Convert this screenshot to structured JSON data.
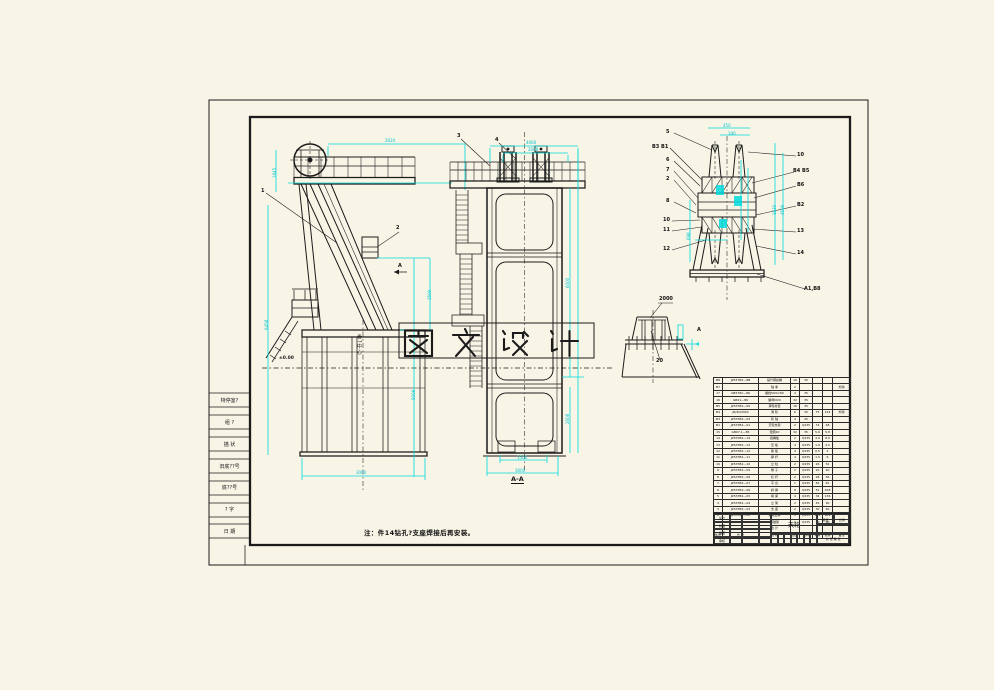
{
  "meta": {
    "background": "#f8f4e6",
    "ink": "#1b1b1b",
    "dim_color": "#00dcdc",
    "watermark_bg": "#ffffff"
  },
  "watermark": {
    "text": "图 文 设 计"
  },
  "note": {
    "text": "注：件14钻孔?支座焊接后再安装。"
  },
  "labels": {
    "ground": "±0.00",
    "hoist_center": "卷?中心",
    "section": "A-A"
  },
  "revision_strip": {
    "rows": [
      "特停室?",
      "组 ?",
      "描 状",
      "旧底??号",
      "底??号",
      "? 字",
      "日 期"
    ]
  },
  "annotations": {
    "callouts": [
      {
        "t": "1",
        "x": 261,
        "y": 189
      },
      {
        "t": "2",
        "x": 396,
        "y": 226
      },
      {
        "t": "A",
        "x": 398,
        "y": 264
      },
      {
        "t": "3",
        "x": 457,
        "y": 134
      },
      {
        "t": "4",
        "x": 495,
        "y": 138
      },
      {
        "t": "5",
        "x": 666,
        "y": 130
      },
      {
        "t": "B3 B1",
        "x": 652,
        "y": 145
      },
      {
        "t": "6",
        "x": 666,
        "y": 158
      },
      {
        "t": "7",
        "x": 666,
        "y": 168
      },
      {
        "t": "2",
        "x": 666,
        "y": 177
      },
      {
        "t": "8",
        "x": 666,
        "y": 199
      },
      {
        "t": "10",
        "x": 663,
        "y": 218
      },
      {
        "t": "11",
        "x": 663,
        "y": 228
      },
      {
        "t": "12",
        "x": 663,
        "y": 247
      },
      {
        "t": "10",
        "x": 797,
        "y": 153
      },
      {
        "t": "B4 B5",
        "x": 793,
        "y": 169
      },
      {
        "t": "B6",
        "x": 797,
        "y": 183
      },
      {
        "t": "B2",
        "x": 797,
        "y": 203
      },
      {
        "t": "13",
        "x": 797,
        "y": 229
      },
      {
        "t": "14",
        "x": 797,
        "y": 251
      },
      {
        "t": "A1,B8",
        "x": 804,
        "y": 287
      },
      {
        "t": "2000",
        "x": 659,
        "y": 297
      },
      {
        "t": "20",
        "x": 656,
        "y": 359
      },
      {
        "t": "A",
        "x": 697,
        "y": 328
      }
    ],
    "dims": [
      {
        "t": "2024",
        "x": 385,
        "y": 139
      },
      {
        "t": "1845",
        "x": 273,
        "y": 178,
        "r": 1
      },
      {
        "t": "6458",
        "x": 265,
        "y": 330,
        "r": 1
      },
      {
        "t": "1500",
        "x": 428,
        "y": 300,
        "r": 1
      },
      {
        "t": "5008",
        "x": 412,
        "y": 400,
        "r": 1
      },
      {
        "t": "3000",
        "x": 356,
        "y": 471
      },
      {
        "t": "4060",
        "x": 526,
        "y": 141
      },
      {
        "t": "2008",
        "x": 528,
        "y": 148
      },
      {
        "t": "6000",
        "x": 566,
        "y": 288,
        "r": 1
      },
      {
        "t": "2608",
        "x": 566,
        "y": 424,
        "r": 1
      },
      {
        "t": "1500",
        "x": 517,
        "y": 456
      },
      {
        "t": "3000",
        "x": 515,
        "y": 469
      },
      {
        "t": "450",
        "x": 723,
        "y": 124
      },
      {
        "t": "340",
        "x": 728,
        "y": 132
      },
      {
        "t": "1630",
        "x": 773,
        "y": 215,
        "r": 1
      },
      {
        "t": "4500",
        "x": 781,
        "y": 215,
        "r": 1
      },
      {
        "t": "698",
        "x": 687,
        "y": 240,
        "r": 1
      }
    ]
  },
  "bom": {
    "rows": [
      [
        "B8",
        "JZ537B2—8B",
        "提升钢丝绳",
        "16",
        "35",
        "",
        "",
        ""
      ],
      [
        "B7",
        "",
        "轴  承",
        "2",
        "",
        "",
        "",
        "外购"
      ],
      [
        "17",
        "GB5782—86",
        "螺栓M20×80",
        "4",
        "35",
        "",
        "",
        ""
      ],
      [
        "16",
        "GB41—86",
        "螺母M20",
        "32",
        "35",
        "",
        "",
        ""
      ],
      [
        "B5",
        "JZ537B2—05",
        "滑轮衬垫",
        "16",
        "35",
        "",
        "",
        ""
      ],
      [
        "B4",
        "JB/ZQ4390",
        "滑  轮",
        "6",
        "35",
        "75",
        "144",
        "外购"
      ],
      [
        "B3",
        "JZ537B2—03",
        "轮  轴",
        "4",
        "45",
        "",
        "",
        ""
      ],
      [
        "B1",
        "JZ537B2—01",
        "天轮支架",
        "2",
        "Q235",
        "74",
        "48",
        ""
      ],
      [
        "15",
        "GB97.1—85",
        "垫圈20",
        "32",
        "35",
        "5.9",
        "5.8",
        ""
      ],
      [
        "14",
        "JZ537B2—14",
        "挡绳板",
        "2",
        "Q235",
        "4.0",
        "8.0",
        ""
      ],
      [
        "13",
        "JZ537B2—13",
        "压  板",
        "4",
        "Q235",
        "1.0",
        "4.0",
        ""
      ],
      [
        "12",
        "JZ537B2—12",
        "筋  板",
        "4",
        "Q235",
        "0.5",
        "2",
        ""
      ],
      [
        "11",
        "JZ537B2—11",
        "撑  杆",
        "4",
        "Q235",
        "1.5",
        "6",
        ""
      ],
      [
        "10",
        "JZ537B2—10",
        "立  柱",
        "2",
        "Q235",
        "26",
        "52",
        ""
      ],
      [
        "9",
        "JZ537B2—09",
        "梯  子",
        "2",
        "Q235",
        "20",
        "40",
        ""
      ],
      [
        "8",
        "JZ537B2—08",
        "栏  杆",
        "2",
        "Q235",
        "28",
        "56",
        ""
      ],
      [
        "7",
        "JZ537B2—07",
        "平  台",
        "1",
        "Q235",
        "81",
        "81",
        ""
      ],
      [
        "6",
        "JZ537B2—06",
        "斜  撑",
        "8",
        "Q235",
        "51",
        "408",
        ""
      ],
      [
        "5",
        "JZ537B2—05",
        "横  梁",
        "4",
        "Q235",
        "34",
        "136",
        ""
      ],
      [
        "4",
        "JZ537B2—04",
        "立  架",
        "2",
        "Q235",
        "45",
        "90",
        ""
      ],
      [
        "3",
        "JZ537B2—03",
        "支  座",
        "2",
        "Q235",
        "30",
        "60",
        ""
      ],
      [
        "2",
        "JZ537B2—02",
        "井架主体",
        "1",
        "Q235",
        "981",
        "981",
        ""
      ],
      [
        "1",
        "JZ537B2—01",
        "基础架",
        "1",
        "Q235",
        "90",
        "90",
        ""
      ]
    ],
    "total_row": [
      "",
      "",
      "合  计",
      "",
      "",
      "",
      "",
      ""
    ],
    "header": [
      "件号",
      "代  号",
      "名  称",
      "数量",
      "材料",
      "单重",
      "总重",
      "备注"
    ]
  },
  "title_block": {
    "sign_rows": [
      [
        "设计",
        "",
        "",
        ""
      ],
      [
        "制图",
        "",
        "",
        ""
      ],
      [
        "描图",
        "",
        "",
        ""
      ],
      [
        "审核",
        "",
        "",
        ""
      ]
    ],
    "name_cell": "天轮",
    "stage_cells": [
      "",
      "",
      "",
      "",
      "",
      "",
      ""
    ],
    "right_weight": "重量",
    "right_scale": "比例",
    "right_mid": "",
    "right_sheet": "共 张 第 张"
  }
}
